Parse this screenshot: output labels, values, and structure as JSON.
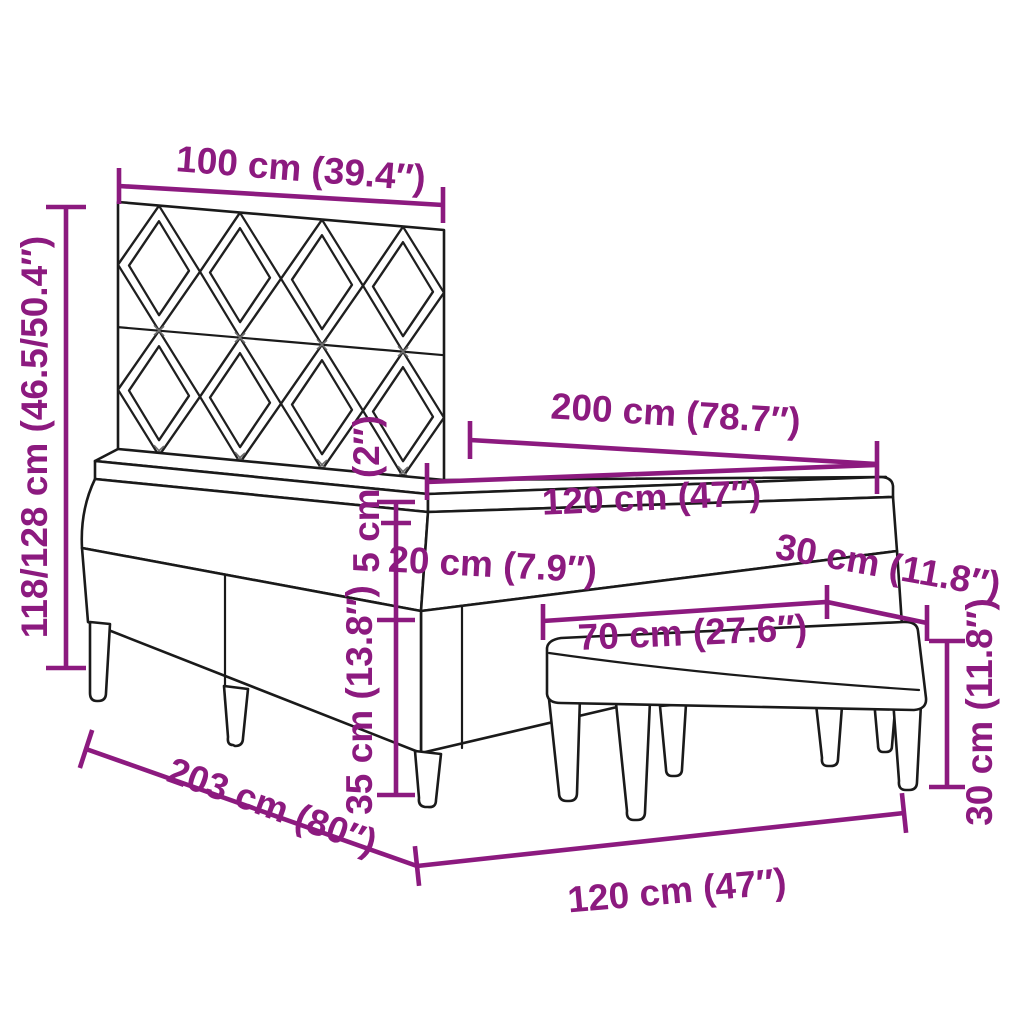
{
  "diagram": {
    "type": "product-dimension-diagram",
    "subject": "box spring bed with diamond-pattern headboard, mattress, topper and upholstered bench",
    "background": "#FFFFFF",
    "colors": {
      "dimension_accent": "#8C1A7F",
      "drawing_outline": "#1A1A1A"
    },
    "dims": {
      "headboard_width": "100 cm (39.4″)",
      "overall_height": "118/128 cm (46.5/50.4″)",
      "bed_length": "200 cm (78.7″)",
      "mattress_width": "120 cm (47″)",
      "topper_thickness": "5 cm (2″)",
      "mattress_thickness": "20 cm (7.9″)",
      "bench_depth": "30 cm (11.8″)",
      "bench_length": "70 cm (27.6″)",
      "base_height": "35 cm (13.8″)",
      "bench_height": "30 cm (11.8″)",
      "frame_length": "203 cm (80″)",
      "frame_width": "120 cm (47″)"
    }
  }
}
